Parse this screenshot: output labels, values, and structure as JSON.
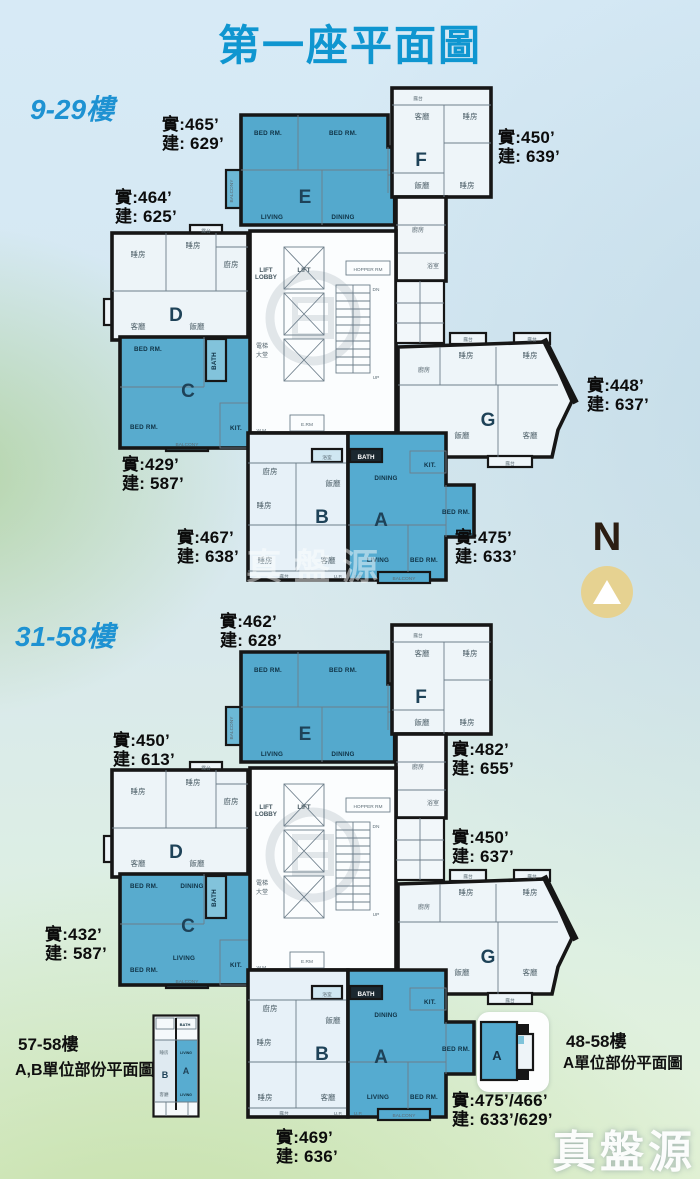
{
  "page": {
    "title": "第一座平面圖",
    "compass": "N",
    "watermark": "真盤源"
  },
  "colors": {
    "title": "#0f96d0",
    "floor_label": "#1e92d2",
    "unit_blue": "#55abd0",
    "unit_light": "#eef5f9",
    "compass_circle": "#e6d291",
    "wall": "#161616"
  },
  "units": {
    "a": "A",
    "b": "B",
    "c": "C",
    "d": "D",
    "e": "E",
    "f": "F",
    "g": "G"
  },
  "rooms": {
    "bed": "BED RM.",
    "living": "LIVING",
    "dining": "DINING",
    "kit": "KIT.",
    "bath": "BATH",
    "balcony": "BALCONY",
    "lift": "LIFT",
    "lobby": "LOBBY",
    "hopper": "HOPPER RM",
    "erm": "E.RM",
    "wm": "W.M.",
    "up": "UP",
    "dn": "DN",
    "upp": "U.P.",
    "lift_hall1": "電梯",
    "lift_hall2": "大堂",
    "living_zh": "客廳",
    "bed_zh": "睡房",
    "kitchen_zh": "廚房",
    "dining_zh": "飯廳",
    "bath_zh": "浴室",
    "balcony_zh": "露台"
  },
  "plan1": {
    "floor_label": "9-29樓",
    "areas": {
      "e": {
        "actual": "實:465’",
        "gross": "建: 629’"
      },
      "f": {
        "actual": "實:450’",
        "gross": "建: 639’"
      },
      "d": {
        "actual": "實:464’",
        "gross": "建: 625’"
      },
      "c": {
        "actual": "實:429’",
        "gross": "建: 587’"
      },
      "b": {
        "actual": "實:467’",
        "gross": "建: 638’"
      },
      "a": {
        "actual": "實:475’",
        "gross": "建: 633’"
      },
      "g": {
        "actual": "實:448’",
        "gross": "建: 637’"
      }
    }
  },
  "plan2": {
    "floor_label": "31-58樓",
    "areas": {
      "e": {
        "actual": "實:462’",
        "gross": "建: 628’"
      },
      "d": {
        "actual": "實:450’",
        "gross": "建: 613’"
      },
      "f": {
        "actual": "實:482’",
        "gross": "建: 655’"
      },
      "g": {
        "actual": "實:450’",
        "gross": "建: 637’"
      },
      "c": {
        "actual": "實:432’",
        "gross": "建: 587’"
      },
      "b": {
        "actual": "實:469’",
        "gross": "建: 636’"
      },
      "a": {
        "actual": "實:475’/466’",
        "gross": "建: 633’/629’"
      }
    }
  },
  "insets": {
    "left": {
      "line1": "57-58樓",
      "line2": "A,B單位部份平面圖"
    },
    "right": {
      "line1": "48-58樓",
      "line2": "A單位部份平面圖"
    }
  }
}
